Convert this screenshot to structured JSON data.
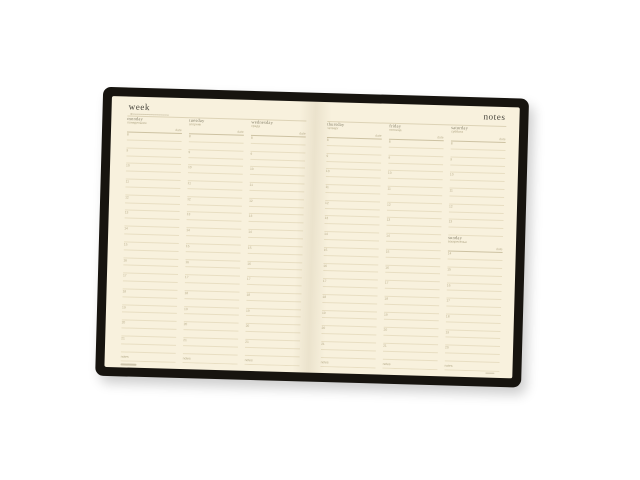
{
  "planner": {
    "left_title": "week",
    "right_title": "notes",
    "date_label": "date",
    "notes_label": "notes",
    "days": [
      {
        "name_en": "monday",
        "name_ru": "понедельник",
        "hours": [
          "8",
          "9",
          "10",
          "11",
          "12",
          "13",
          "14",
          "15",
          "16",
          "17",
          "18",
          "19",
          "20",
          "21"
        ]
      },
      {
        "name_en": "tuesday",
        "name_ru": "вторник",
        "hours": [
          "8",
          "9",
          "10",
          "11",
          "12",
          "13",
          "14",
          "15",
          "16",
          "17",
          "18",
          "19",
          "20",
          "21"
        ]
      },
      {
        "name_en": "wednesday",
        "name_ru": "среда",
        "hours": [
          "8",
          "9",
          "10",
          "11",
          "12",
          "13",
          "14",
          "15",
          "16",
          "17",
          "18",
          "19",
          "20",
          "21"
        ]
      },
      {
        "name_en": "thursday",
        "name_ru": "четверг",
        "hours": [
          "8",
          "9",
          "10",
          "11",
          "12",
          "13",
          "14",
          "15",
          "16",
          "17",
          "18",
          "19",
          "20",
          "21"
        ]
      },
      {
        "name_en": "friday",
        "name_ru": "пятница",
        "hours": [
          "8",
          "9",
          "10",
          "11",
          "12",
          "13",
          "14",
          "15",
          "16",
          "17",
          "18",
          "19",
          "20",
          "21"
        ]
      },
      {
        "name_en": "saturday",
        "name_ru": "суббота",
        "hours": [
          "8",
          "9",
          "10",
          "11",
          "12",
          "13"
        ]
      },
      {
        "name_en": "sunday",
        "name_ru": "воскресенье",
        "hours": [
          "14",
          "15",
          "16",
          "17",
          "18",
          "19",
          "20"
        ]
      }
    ],
    "layout": {
      "left_page_days": [
        0,
        1,
        2
      ],
      "right_page_days": [
        3,
        4
      ],
      "right_page_split_column_days": [
        5,
        6
      ]
    },
    "colors": {
      "cover": "#17140f",
      "page": "#f8f1dd",
      "rule_line": "#e8dec2",
      "day_header_rule": "#cdc2a2",
      "title_text": "#45433a",
      "day_name_text": "#827d66",
      "muted_text": "#b3a987",
      "background": "#ffffff"
    }
  }
}
